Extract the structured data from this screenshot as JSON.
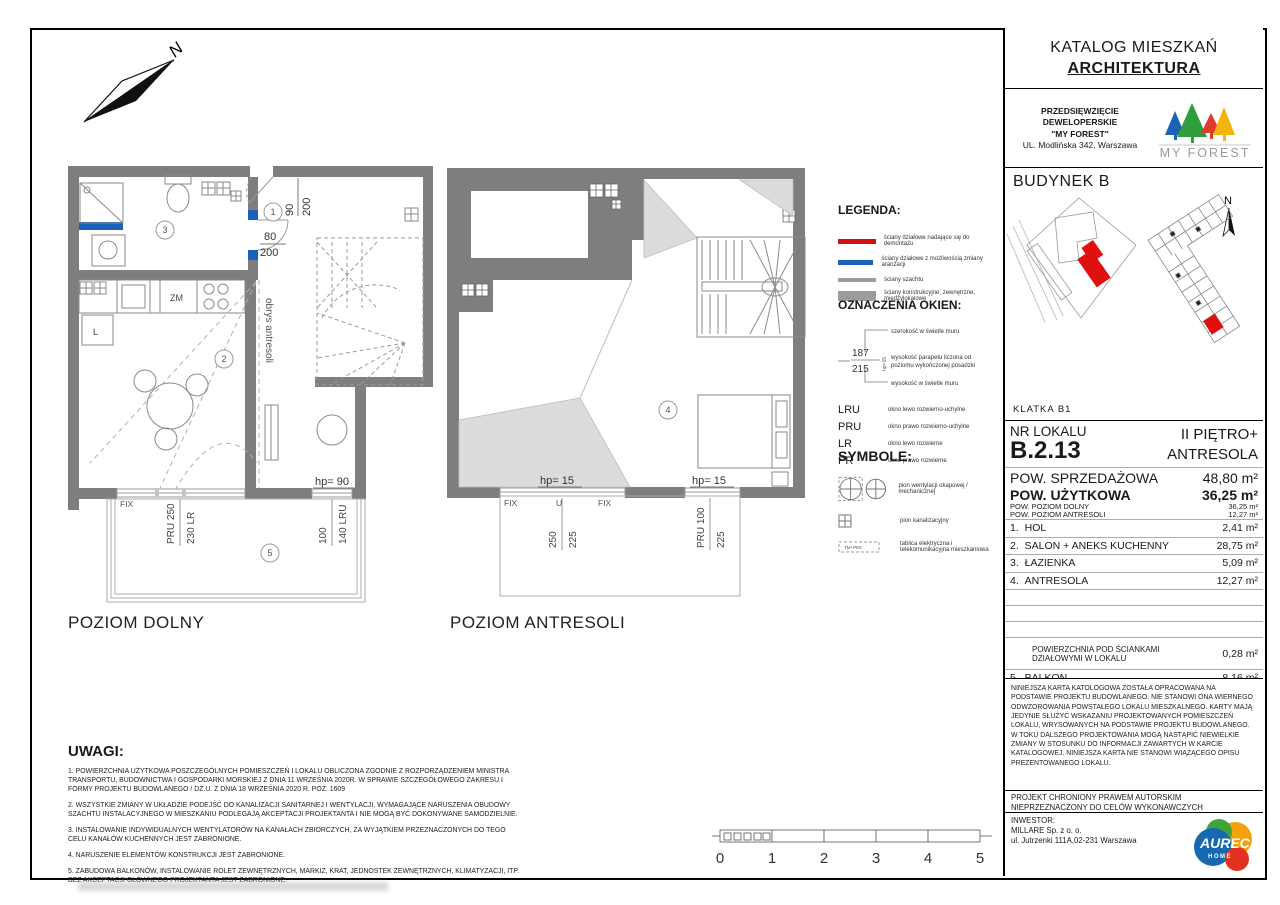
{
  "page": {
    "title_line1": "KATALOG MIESZKAŃ",
    "title_line2": "ARCHITEKTURA"
  },
  "developer": {
    "line1": "PRZEDSIĘWZIĘCIE",
    "line2": "DEWELOPERSKIE",
    "line3": "\"MY FOREST\"",
    "line4": "UL. Modlińska 342, Warszawa",
    "brand": "MY FOREST"
  },
  "building": {
    "label": "BUDYNEK B",
    "klatka": "KLATKA B1"
  },
  "compass": {
    "page_north": "N",
    "site_north": "N"
  },
  "unit": {
    "nr_label": "NR LOKALU",
    "nr": "B.2.13",
    "floor_line1": "II PIĘTRO+",
    "floor_line2": "ANTRESOLA",
    "sales_label": "POW. SPRZEDAŻOWA",
    "sales_value": "48,80 m²",
    "usable_label": "POW. UŻYTKOWA",
    "usable_value": "36,25 m²",
    "sub_rows": [
      {
        "label": "POW. POZIOM DOLNY",
        "value": "36,25 m²"
      },
      {
        "label": "POW. POZIOM ANTRESOLI",
        "value": "12,27 m²"
      }
    ],
    "rooms": [
      {
        "no": "1.",
        "name": "HOL",
        "area": "2,41 m²"
      },
      {
        "no": "2.",
        "name": "SALON + ANEKS KUCHENNY",
        "area": "28,75 m²"
      },
      {
        "no": "3.",
        "name": "ŁAZIENKA",
        "area": "5,09 m²"
      },
      {
        "no": "4.",
        "name": "ANTRESOLA",
        "area": "12,27 m²"
      }
    ],
    "partition_label": "POWIERZCHNIA POD ŚCIANKAMI\nDZIAŁOWYMI W LOKALU",
    "partition_value": "0,28 m²",
    "balcony_no": "5.",
    "balcony_name": "BALKON",
    "balcony_value": "8,16 m²"
  },
  "disclaimer": "NINIEJSZA KARTA KATOLOGOWA ZOSTAŁA OPRACOWANA NA PODSTAWIE PROJEKTU BUDOWLANEGO. NIE STANOWI ONA WIERNEGO ODWZOROWANIA POWSTAŁEGO LOKALU MIESZKALNEGO. KARTY MAJĄ JEDYNIE SŁUŻYĆ WSKAZANIU PROJEKTOWANYCH POMIESZCZEŃ LOKALU, WRYSOWANYCH NA PODSTAWIE PROJEKTU BUDOWLANEGO.\nW TOKU DALSZEGO PROJEKTOWANIA MOGĄ NASTĄPIĆ NIEWIELKIE ZMIANY W STOSUNKU DO INFORMACJI ZAWARTYCH W KARCIE KATALOGOWEJ. NINIEJSZA KARTA NIE STANOWI WIĄŻĄCEGO OPISU PREZENTOWANEGO LOKALU.",
  "copyright": {
    "line1": "PROJEKT CHRONIONY PRAWEM AUTORSKIM",
    "line2": "NIEPRZEZNACZONY DO CELÓW WYKONAWCZYCH"
  },
  "investor": {
    "label": "INWESTOR:",
    "name": "MILLARE Sp. z o. o.",
    "address": "ul. Jutrzenki 111A,02-231 Warszawa",
    "logo_text": "AUREC",
    "logo_sub": "HOME"
  },
  "legend": {
    "title": "LEGENDA:",
    "items": [
      {
        "color": "#d40f0f",
        "text": "ściany działowe nadające się do demontażu"
      },
      {
        "color": "#1a62b8",
        "text": "ściany działowe z możliwością zmiany aranżacji"
      },
      {
        "color": "#9c9c9c",
        "text": "ściany szachtu"
      },
      {
        "color": "#9c9c9c",
        "text": "ściany konstrukcyjne, zewnętrzne,\nmiędzylokalowe"
      }
    ]
  },
  "windows_key": {
    "title": "OZNACZENIA OKIEN:",
    "ex_top": "187",
    "ex_bottom": "215",
    "ex_hp": "hp=15",
    "ann_width": "szerokość w świetle muru",
    "ann_sill1": "wysokość parapetu liczona od",
    "ann_sill2": "poziomu wykończonej posadzki",
    "ann_height": "wysokość w świetle muru",
    "codes": [
      {
        "code": "LRU",
        "desc": "okno lewo rozwierno-uchylne"
      },
      {
        "code": "PRU",
        "desc": "okno prawo rozwierno-uchylne"
      },
      {
        "code": "LR",
        "desc": "okno lewo rozwierne"
      },
      {
        "code": "PR",
        "desc": "okno prawo rozwierne"
      }
    ]
  },
  "symbols": {
    "title": "SYMBOLE:",
    "vent_text": "pion wentylacji okapowej / mechanicznej",
    "sewage_text": "pion kanalizacyjny",
    "board_text": "tablica elektryczna i\ntelekomunikacyjna mieszkaniowa",
    "board_label": "TM+PEK"
  },
  "uwagi": {
    "title": "UWAGI:",
    "items": [
      "1. POWIERZCHNIA UŻYTKOWA POSZCZEGÓLNYCH POMIESZCZEŃ I LOKALU OBLICZONA ZGODNIE Z ROZPORZĄDZENIEM MINISTRA TRANSPORTU, BUDOWNICTWA I GOSPODARKI MORSKIEJ Z DNIA 11 WRZEŚNIA 2020R. W SPRAWIE SZCZEGÓŁOWEGO ZAKRESU I FORMY PROJEKTU BUDOWLANEGO / DZ.U. Z DNIA 18 WRZEŚNIA 2020 R. POZ. 1609",
      "2. WSZYSTKIE ZMIANY W UKŁADZIE PODEJŚĆ DO KANALIZACJI SANITARNEJ I WENTYLACJI, WYMAGAJĄCE NARUSZENIA OBUDOWY SZACHTU INSTALACYJNEGO W MIESZKANIU PODLEGAJĄ AKCEPTACJI PROJEKTANTA I NIE MOGĄ BYĆ DOKONYWANE SAMODZIELNIE.",
      "3. INSTALOWANIE INDYWIDUALNYCH WENTYLATORÓW NA KANAŁACH ZBIORCZYCH, ZA WYJĄTKIEM PRZEZNACZONYCH DO TEGO CELU KANAŁÓW KUCHENNYCH JEST ZABRONIONE.",
      "4. NARUSZENIE ELEMENTÓW KONSTRUKCJI JEST ZABRONIONE.",
      "5. ZABUDOWA BALKONÓW, INSTALOWANIE ROLET ZEWNĘTRZNYCH, MARKIZ, KRAT, JEDNOSTEK ZEWNĘTRZNYCH, KLIMATYZACJI, ITP. BEZ AKCEPTACJI GŁÓWNEGO PROJEKTANTA JEST ZABRONIONE."
    ]
  },
  "scale": {
    "ticks": [
      "0",
      "1",
      "2",
      "3",
      "4",
      "5"
    ]
  },
  "plan_lower": {
    "caption": "POZIOM DOLNY",
    "obrys": "obrys antresoli",
    "room1": "1",
    "room2": "2",
    "room3": "3",
    "room5": "5",
    "door1_w": "90",
    "door1_h": "200",
    "door2_w": "80",
    "door2_h": "200",
    "zm": "ZM",
    "l": "L",
    "fix": "FIX",
    "win1_left": "PRU 250",
    "win1_right": "230 LR",
    "hp90": "hp= 90",
    "win2_left": "100",
    "win2_right": "140 LRU"
  },
  "plan_upper": {
    "caption": "POZIOM ANTRESOLI",
    "room4": "4",
    "hp15_left": "hp= 15",
    "hp15_right": "hp= 15",
    "fix_left": "FIX",
    "u": "U",
    "fix_right": "FIX",
    "win1_a": "250",
    "win1_b": "225",
    "win2_a": "PRU 100",
    "win2_b": "225"
  },
  "colors": {
    "wall_gray": "#7e7e7e",
    "shade_gray": "#dcdcdc",
    "legend_red": "#d40f0f",
    "legend_blue": "#1a62b8",
    "unit_red": "#e01010",
    "forest_blue": "#1b63b0",
    "forest_green": "#2f9e3c",
    "forest_red": "#e03a2f",
    "forest_yellow": "#f2b50d",
    "aurec_blue": "#1668b0",
    "aurec_green": "#3ea437",
    "aurec_orange": "#f3a20c",
    "aurec_red": "#e23322"
  }
}
